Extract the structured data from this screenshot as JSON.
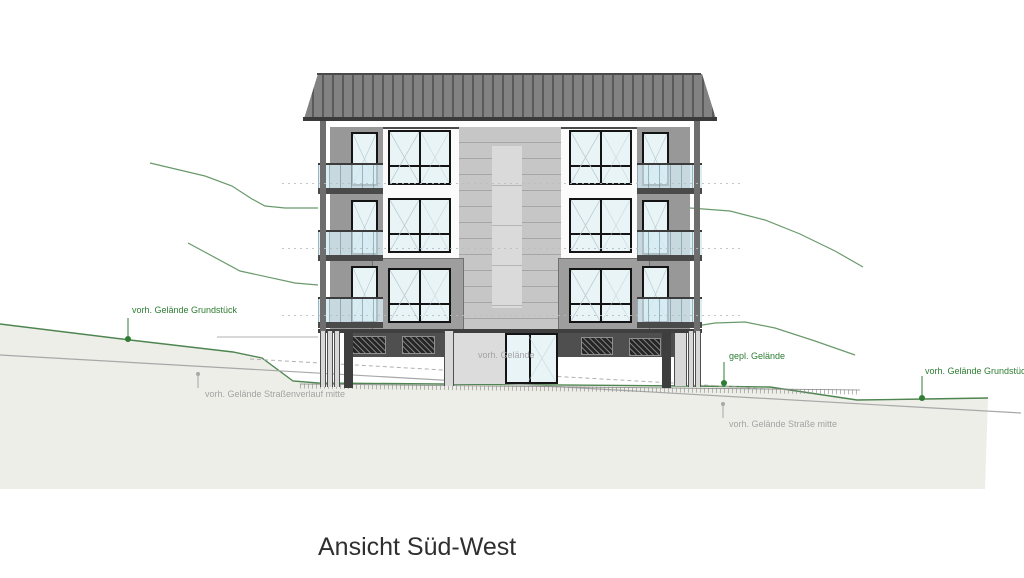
{
  "drawing": {
    "title": "Ansicht Süd-West",
    "annotations": {
      "existing_ground_plot_left": "vorh. Gelände Grundstück",
      "existing_ground_street_course_mid": "vorh. Gelände Straßenverlauf mitte",
      "existing_ground_center": "vorh. Gelände",
      "planned_ground": "gepl. Gelände",
      "existing_ground_street_mid": "vorh. Gelände Straße mitte",
      "existing_ground_plot_right": "vorh. Gelände Grundstück"
    },
    "colors": {
      "annotation_green": "#2e7d32",
      "annotation_gray": "#a3a3a3",
      "terrain_fill": "#edeee7",
      "terrain_line_green": "#4e8550",
      "roof_gray": "#7b7b7b",
      "glass_blue": "#d9edf3",
      "title_color": "#2f2f2f"
    }
  }
}
